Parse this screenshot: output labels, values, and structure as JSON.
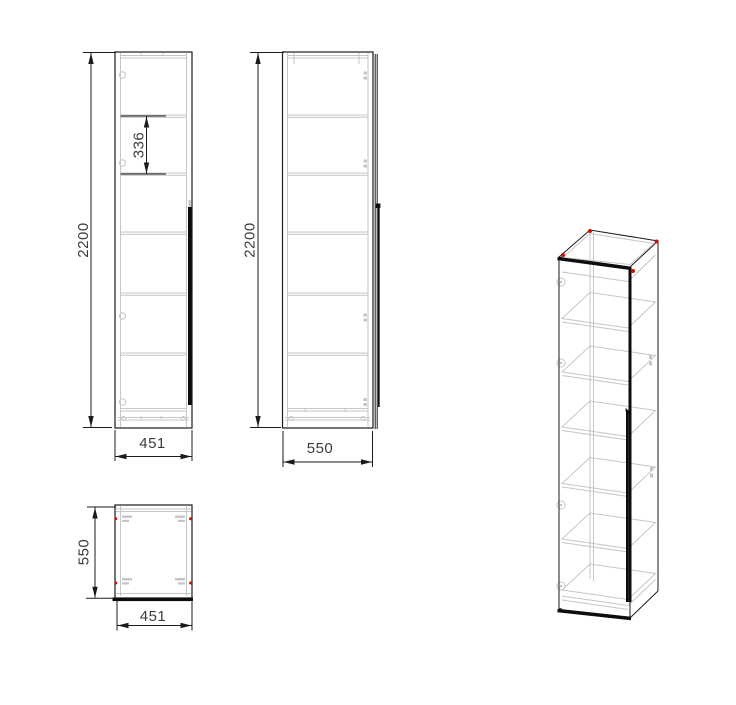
{
  "drawing": {
    "type": "cabinet-technical-drawing",
    "background": "#ffffff",
    "colors": {
      "outline": "#1b1b1b",
      "secondary_lines": "#c6c6c6",
      "fitting_marker": "#cc1100",
      "dimension_text": "#3c3c3c"
    },
    "views": {
      "front": {
        "dims": {
          "height": "2200",
          "shelf_pitch": "336",
          "width": "451"
        },
        "shelf_count": 5
      },
      "side": {
        "dims": {
          "height": "2200",
          "depth": "550"
        }
      },
      "plan": {
        "dims": {
          "depth": "550",
          "width": "451"
        }
      },
      "iso": {
        "description": "isometric wireframe of tall single-door cabinet with shelves"
      }
    }
  }
}
